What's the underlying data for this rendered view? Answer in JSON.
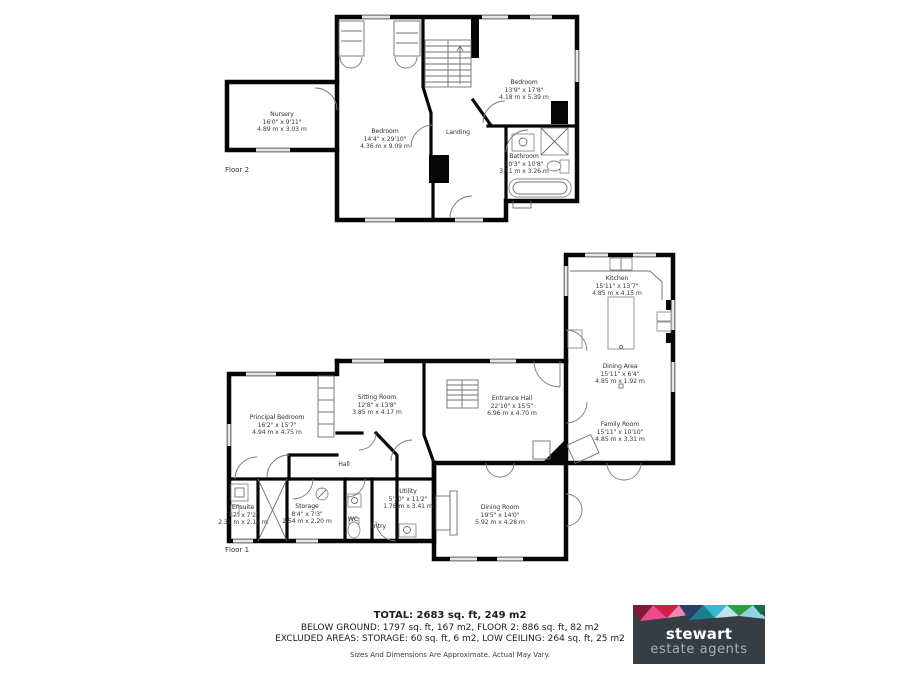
{
  "floor2": {
    "label": "Floor 2",
    "rooms": {
      "nursery": {
        "name": "Nursery",
        "ft": "16'0\" x 9'11\"",
        "m": "4.89 m x 3.03 m"
      },
      "bedroom": {
        "name": "Bedroom",
        "ft": "14'4\" x 29'10\"",
        "m": "4.36 m x 9.09 m"
      },
      "landing": {
        "name": "Landing"
      },
      "bedroom2": {
        "name": "Bedroom",
        "ft": "13'9\" x 17'8\"",
        "m": "4.18 m x 5.39 m"
      },
      "bathroom": {
        "name": "Bathroom",
        "ft": "10'3\" x 10'8\"",
        "m": "3.11 m x 3.26 m"
      }
    }
  },
  "floor1": {
    "label": "Floor 1",
    "rooms": {
      "kitchen": {
        "name": "Kitchen",
        "ft": "15'11\" x 13'7\"",
        "m": "4.85 m x 4.15 m"
      },
      "dining_area": {
        "name": "Dining Area",
        "ft": "15'11\" x 6'4\"",
        "m": "4.85 m x 1.92 m"
      },
      "family_room": {
        "name": "Family Room",
        "ft": "15'11\" x 10'10\"",
        "m": "4.85 m x 3.31 m"
      },
      "entrance_hall": {
        "name": "Entrance Hall",
        "ft": "22'10\" x 15'5\"",
        "m": "6.96 m x 4.70 m"
      },
      "sitting_room": {
        "name": "Sitting Room",
        "ft": "12'8\" x 13'8\"",
        "m": "3.85 m x 4.17 m"
      },
      "principal_bedroom": {
        "name": "Principal Bedroom",
        "ft": "16'2\" x 15'7\"",
        "m": "4.94 m x 4.75 m"
      },
      "hall": {
        "name": "Hall"
      },
      "ensuite": {
        "name": "Ensuite",
        "ft": "7'7\" x 7'2\"",
        "m": "2.31 m x 2.19 m"
      },
      "storage": {
        "name": "Storage",
        "ft": "8'4\" x 7'3\"",
        "m": "2.54 m x 2.20 m"
      },
      "wc": {
        "name": "WC"
      },
      "entry": {
        "name": "Entry"
      },
      "utility": {
        "name": "Utility",
        "ft": "5'10\" x 11'2\"",
        "m": "1.78 m x 3.41 m"
      },
      "dining_room": {
        "name": "Dining Room",
        "ft": "19'5\" x 14'0\"",
        "m": "5.92 m x 4.28 m"
      }
    }
  },
  "footer": {
    "total": "TOTAL: 2683 sq. ft, 249 m2",
    "line2": "BELOW GROUND: 1797 sq. ft, 167 m2, FLOOR 2: 886 sq. ft, 82 m2",
    "line3": "EXCLUDED AREAS: STORAGE: 60 sq. ft, 6 m2, LOW CEILING: 264 sq. ft, 25 m2",
    "disclaimer": "Sizes And Dimensions Are Approximate. Actual May Vary."
  },
  "logo": {
    "brand": "stewart",
    "tagline": "estate agents",
    "colors": {
      "background": "#363e44",
      "maroon": "#7e1c31",
      "pink": "#ee4b8d",
      "crimson": "#d01f47",
      "navy": "#28406b",
      "teal": "#1b7f8c",
      "cyan": "#35b9d6",
      "green": "#2f9e3f",
      "light_blue": "#8fd3e4"
    }
  }
}
